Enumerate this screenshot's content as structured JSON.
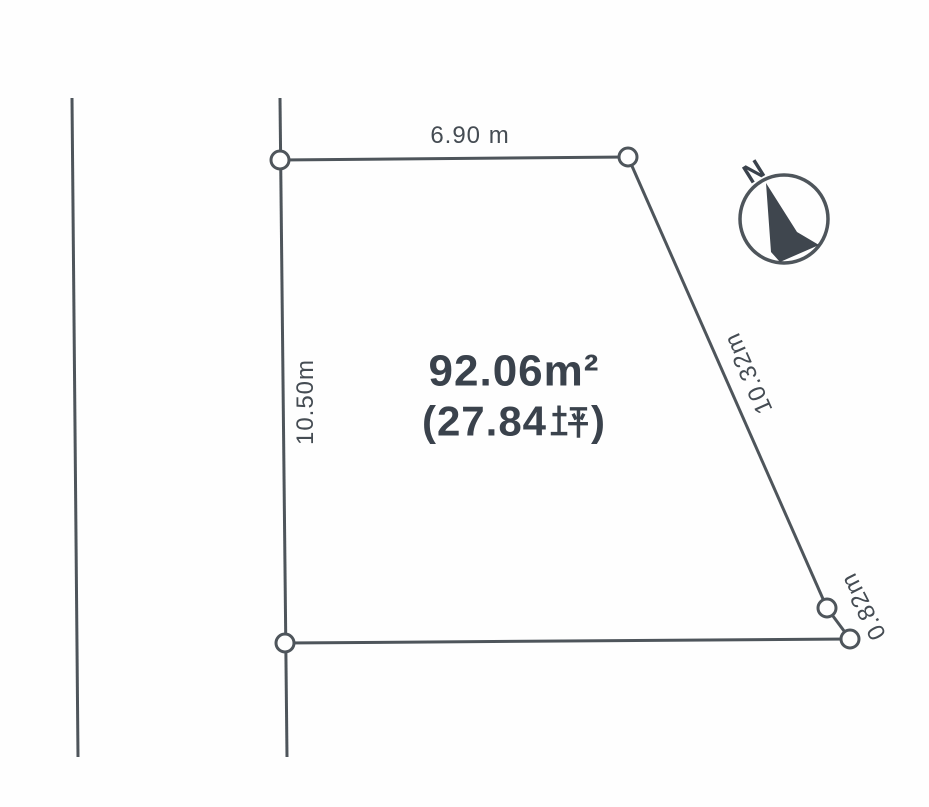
{
  "canvas": {
    "background": "#fefefe",
    "line_color": "#4e555b",
    "text_color": "#454c53",
    "area_text_color": "#3a424c",
    "arrow_color": "#3f464e"
  },
  "plot": {
    "area_sqm": "92.06m²",
    "area_tsubo": "(27.84坪)",
    "area_tsubo_prefix": "(27.84",
    "area_tsubo_unit": "坪",
    "area_tsubo_suffix": ")",
    "dimensions": {
      "top": "6.90 m",
      "left": "10.50m",
      "right": "10.32m",
      "bottom_right": "0.82m"
    }
  },
  "compass": {
    "label": "N"
  }
}
